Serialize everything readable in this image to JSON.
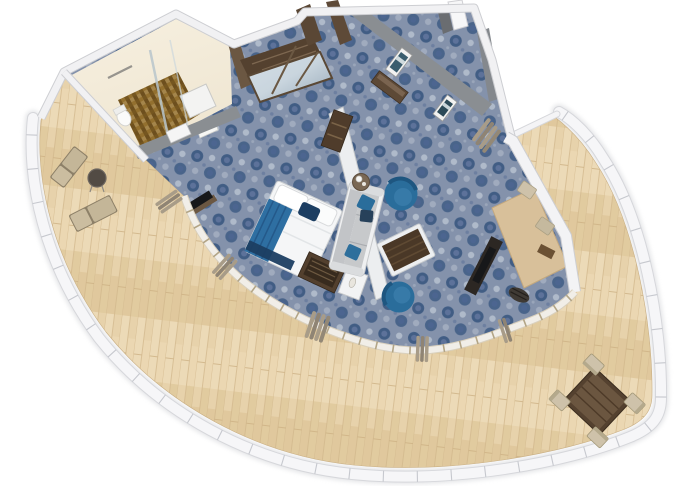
{
  "scene": {
    "title": "Cruise ship suite - 3D isometric floor plan rendering",
    "view": "top-down isometric artist rendering",
    "background": "#ffffff"
  },
  "palette": {
    "background": "#ffffff",
    "hull_band": "#f6f6f8",
    "hull_edge": "#d6d7db",
    "railing_tick": "#c6c8ce",
    "deck_wood": "#e7d2ab",
    "deck_plank_dark": "#ddc497",
    "deck_plank_light": "#eedcba",
    "carpet_base": "#8492ab",
    "carpet_dark": "#35547e",
    "carpet_light": "#b4bfcd",
    "wall_white": "#f1f1f3",
    "wall_edge": "#c9cacd",
    "wall_gray": "#8a8e92",
    "bath_wall_cream": "#efe6d2",
    "bath_floor_brown": "#8a6a33",
    "wood_dark": "#54412f",
    "wood_mid": "#6b5742",
    "mirror_blue": "#c9d5de",
    "bed_white": "#f5f6f7",
    "bed_teal": "#2e6fa2",
    "bed_navy": "#1c3e62",
    "sofa_gray": "#c7c9cb",
    "sofa_trim": "#eff0f1",
    "chair_teal": "#2a6d9b",
    "chair_teal_dark": "#1e5680",
    "coffee_table_wood": "#4a3827",
    "coffee_table_frame": "#edeff1",
    "desk_wood": "#d8c09a",
    "curtain_khaki": "#a89c88",
    "window_frame": "#b3a586",
    "beige_seat": "#cec2aa",
    "lounger_beige": "#cbbda0",
    "tv_black": "#17181a"
  },
  "rooms": {
    "bathroom": {
      "label": "Bathroom",
      "floor": "brown mosaic tile",
      "furniture": [
        "walk-in shower",
        "glass partition",
        "toilet",
        "vanity sink",
        "towel bar"
      ]
    },
    "entry": {
      "label": "Entry corridor",
      "floor": "blue patterned carpet",
      "furniture": [
        "entry door",
        "mirrored wardrobe",
        "minibar cabinet",
        "console bench",
        "framed picture",
        "framed picture"
      ]
    },
    "bedroom": {
      "label": "Bedroom",
      "floor": "blue patterned carpet",
      "furniture": [
        "king bed with teal runner and navy pillows",
        "luggage bench",
        "tv panel",
        "curtains",
        "sliding glass doors"
      ]
    },
    "living_room": {
      "label": "Living room",
      "floor": "blue patterned carpet",
      "furniture": [
        "sofa with blue pillows",
        "tub armchair",
        "tub armchair",
        "coffee table",
        "lamp side table",
        "side shelf",
        "tv panel",
        "desk with chair"
      ]
    },
    "balcony": {
      "label": "Wrap-around balcony",
      "floor": "teak deck planks",
      "furniture": [
        "sun lounger",
        "sun lounger",
        "round side table",
        "dining table",
        "dining chair",
        "dining chair",
        "dining chair",
        "dining chair",
        "deck chair",
        "deck chair"
      ],
      "railing": "white curved railing with glass panels"
    }
  }
}
